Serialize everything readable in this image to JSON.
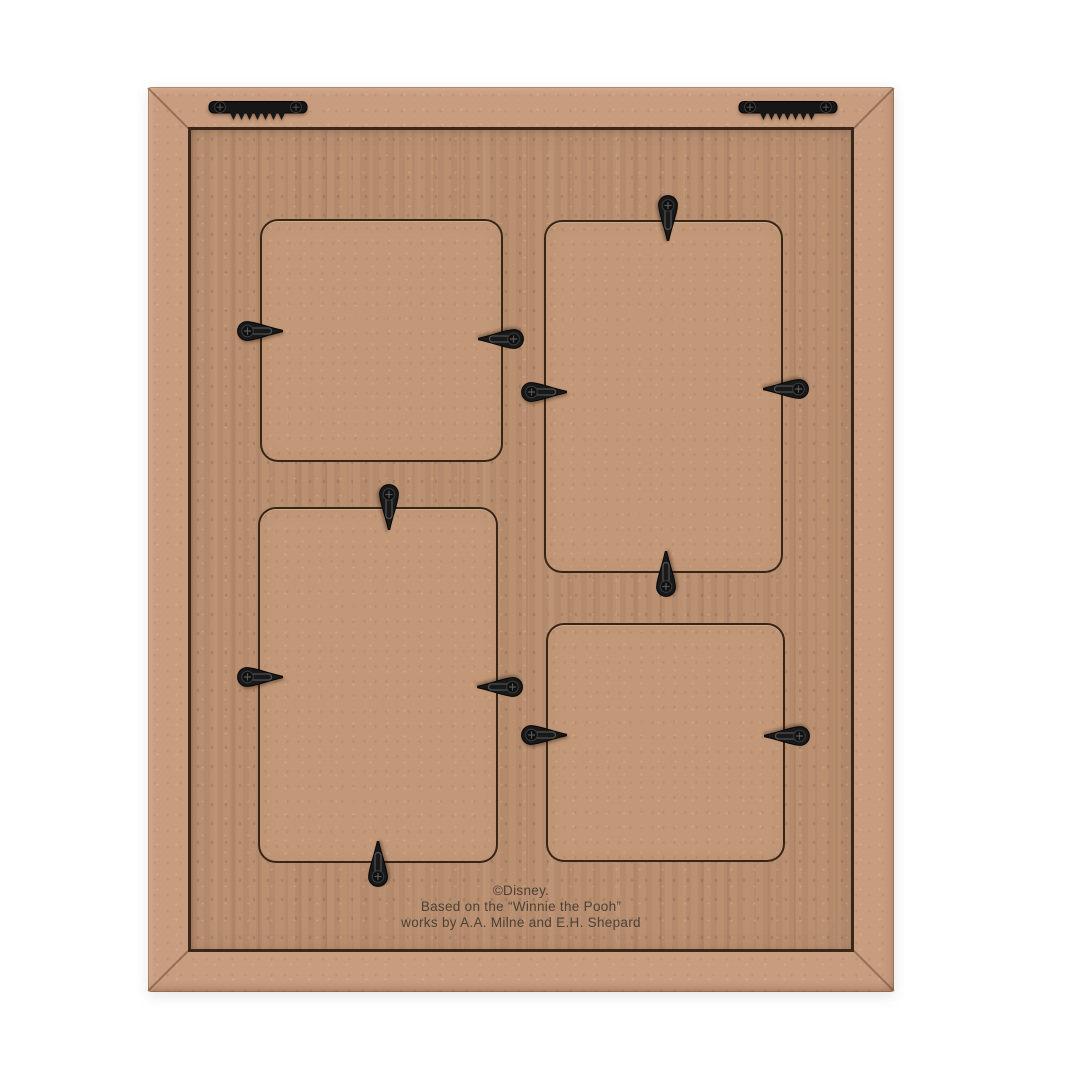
{
  "product": {
    "backing_text": {
      "line1": "©Disney.",
      "line2": "Based on the “Winnie the Pooh”",
      "line3": "works by A.A. Milne and E.H. Shepard"
    }
  },
  "colors": {
    "background": "#ffffff",
    "frame_molding": "#c89c7e",
    "back_panel": "#ba8f71",
    "insert_panel": "#c39878",
    "cut_line": "#2b1c10",
    "hardware_black": "#161616",
    "text": "#4b4138"
  },
  "frame": {
    "x": 148,
    "y": 87,
    "w": 746,
    "h": 905,
    "molding_width": 40
  },
  "openings": [
    {
      "id": "top-left",
      "x": 112,
      "y": 132,
      "w": 243,
      "h": 243
    },
    {
      "id": "top-right",
      "x": 396,
      "y": 133,
      "w": 239,
      "h": 353
    },
    {
      "id": "bottom-left",
      "x": 110,
      "y": 420,
      "w": 240,
      "h": 356
    },
    {
      "id": "bottom-right",
      "x": 398,
      "y": 536,
      "w": 239,
      "h": 239
    }
  ],
  "swivel_clips": [
    {
      "cx": 112,
      "cy": 244,
      "dir": "right"
    },
    {
      "cx": 353,
      "cy": 252,
      "dir": "left"
    },
    {
      "cx": 520,
      "cy": 131,
      "dir": "down"
    },
    {
      "cx": 396,
      "cy": 305,
      "dir": "right"
    },
    {
      "cx": 638,
      "cy": 302,
      "dir": "left"
    },
    {
      "cx": 518,
      "cy": 487,
      "dir": "up"
    },
    {
      "cx": 241,
      "cy": 420,
      "dir": "down"
    },
    {
      "cx": 112,
      "cy": 590,
      "dir": "right"
    },
    {
      "cx": 352,
      "cy": 600,
      "dir": "left"
    },
    {
      "cx": 230,
      "cy": 777,
      "dir": "up"
    },
    {
      "cx": 396,
      "cy": 648,
      "dir": "right"
    },
    {
      "cx": 639,
      "cy": 649,
      "dir": "left"
    }
  ],
  "sawtooth_hangers": [
    {
      "x": 60,
      "y": 11
    },
    {
      "x": 590,
      "y": 11
    }
  ]
}
